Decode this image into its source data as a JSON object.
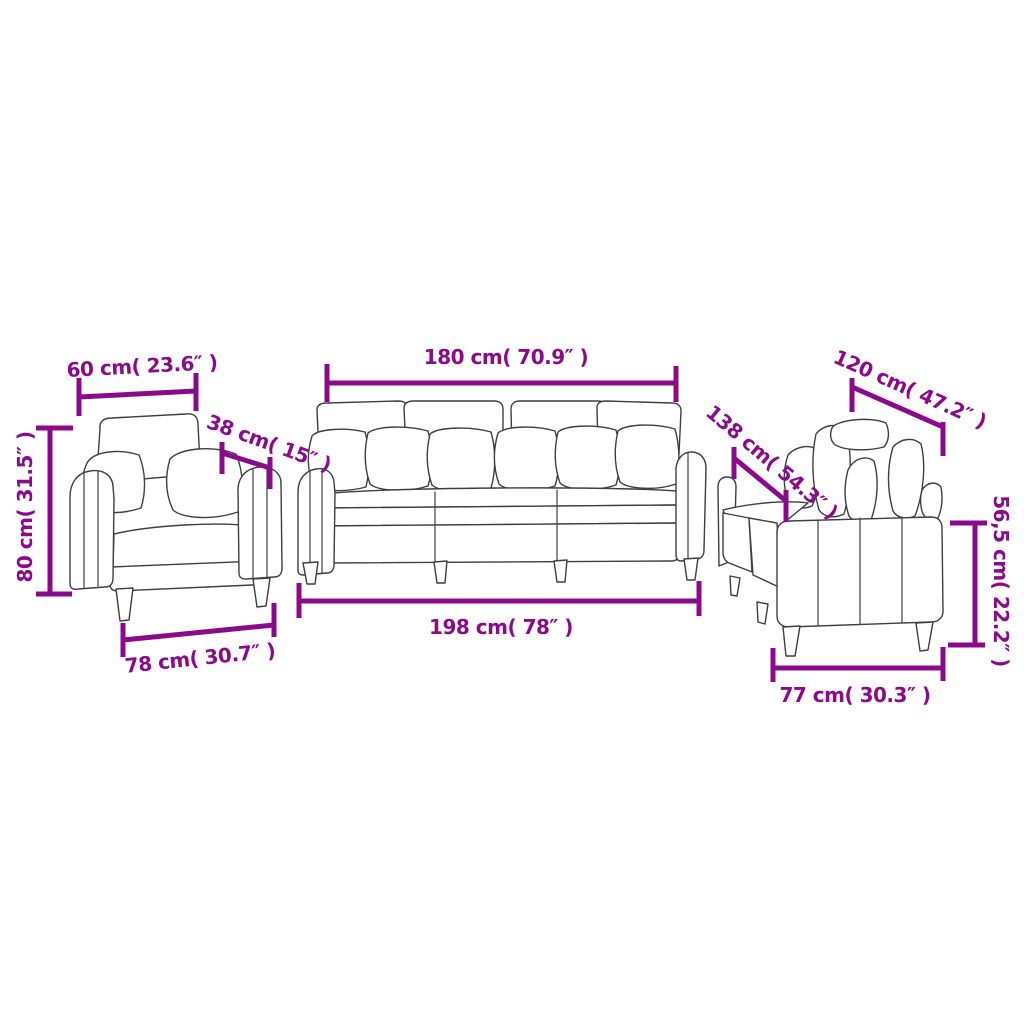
{
  "diagram": {
    "background_color": "#FFFFFF",
    "accent_color": "#8B0A8C",
    "line_color": "#3F3F3F",
    "pieces": [
      {
        "id": "armchair",
        "labels": {
          "width_top": "60 cm( 23.6″ )",
          "depth": "38 cm( 15″ )",
          "height": "80 cm( 31.5″ )",
          "width_bottom": "78 cm( 30.7″ )"
        }
      },
      {
        "id": "three-seater-sofa",
        "labels": {
          "width_top": "180 cm( 70.9″ )",
          "width_bottom": "198 cm( 78″ )"
        }
      },
      {
        "id": "two-seater-sofa",
        "labels": {
          "width_top": "120 cm( 47.2″ )",
          "depth": "138 cm( 54.3″ )",
          "height": "56,5 cm( 22.2″ )",
          "width_bottom": "77 cm( 30.3″ )"
        }
      }
    ]
  }
}
